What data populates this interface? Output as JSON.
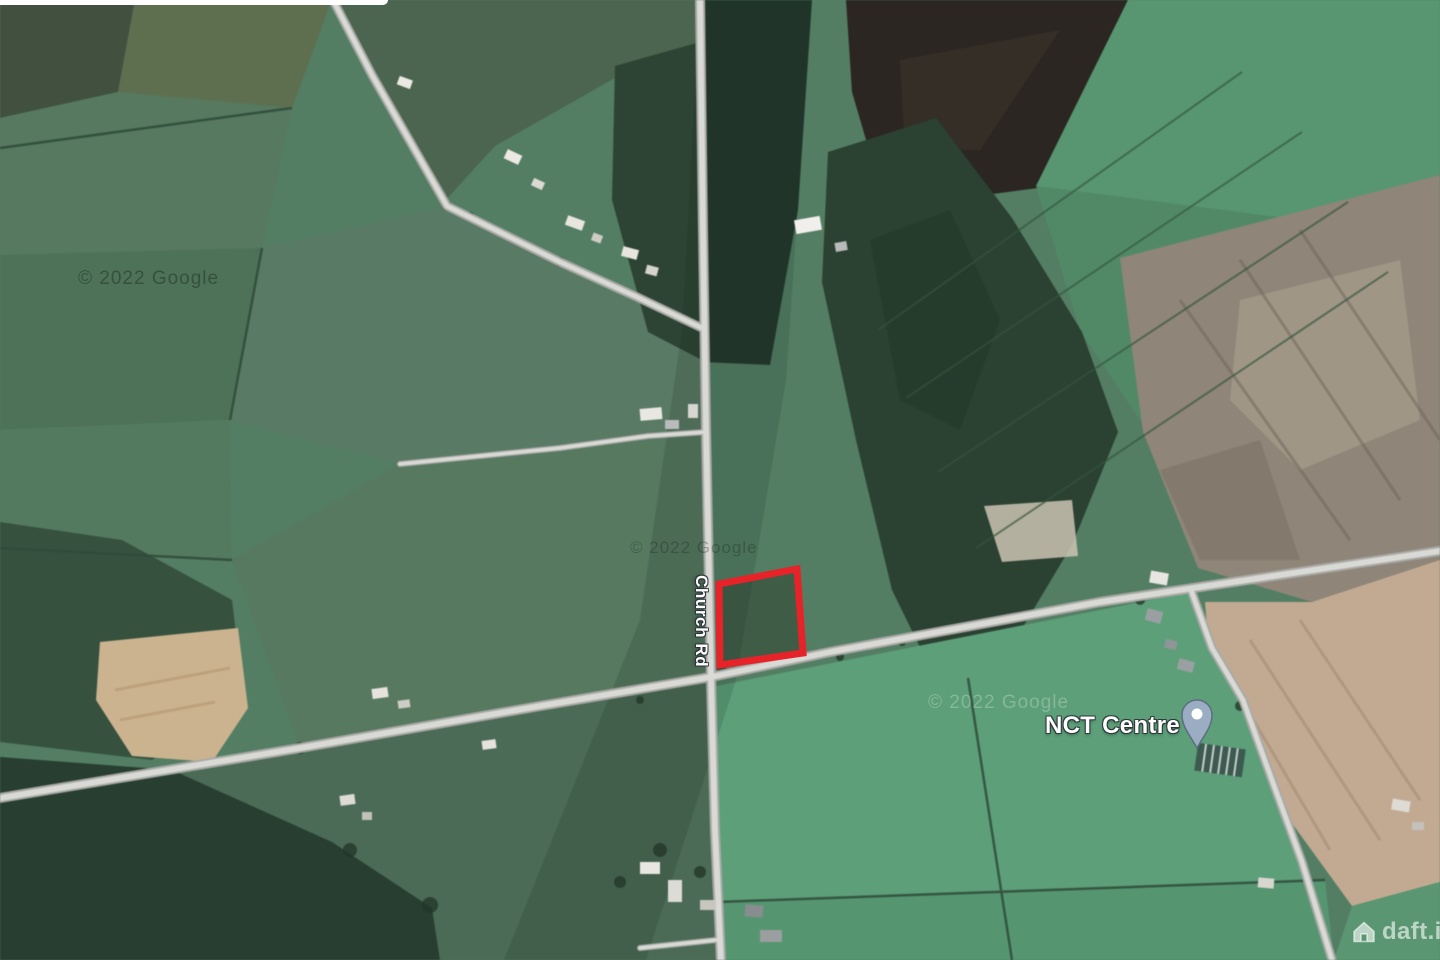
{
  "map": {
    "type": "satellite",
    "road_label": "Church Rd",
    "poi": {
      "name": "NCT Centre",
      "marker_icon": "map-pin-icon",
      "marker_color": "#9badc2"
    },
    "plot": {
      "outline_color": "#e62329"
    },
    "watermarks": {
      "top_left": "© 2022 Google",
      "center": "© 2022 Google",
      "right": "© 2022 Google"
    },
    "branding": {
      "icon": "house-icon",
      "text": "daft.ie"
    },
    "palette": {
      "bright_field_green": "#5aa078",
      "muted_field_green": "#587a63",
      "forest_dark_green": "#2a4132",
      "bog_gray_brown": "#8f8577",
      "bog_pink_tan": "#c3aa91",
      "tilled_bog_dark": "#2b2621",
      "tan_field": "#cdb38d",
      "road_gray": "#d9d9d6"
    }
  }
}
